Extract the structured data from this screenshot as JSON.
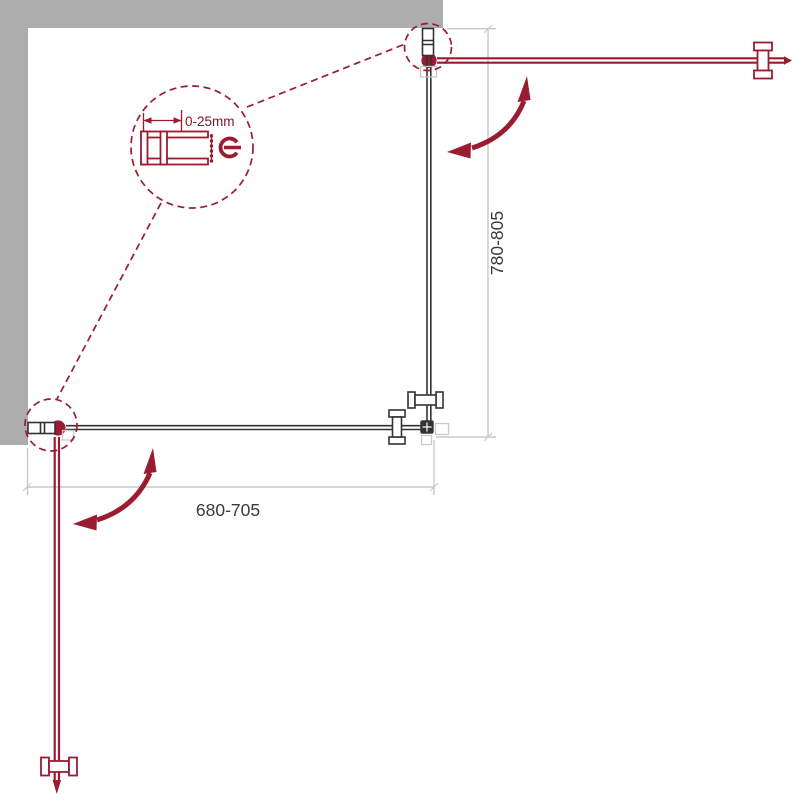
{
  "diagram": {
    "type": "shower-enclosure-installation-drawing",
    "dimensions": {
      "height_label": "780-805",
      "width_label": "680-705",
      "profile_adjustment_label": "0-25mm"
    }
  },
  "colors": {
    "red": "#9b1c31",
    "red-dark": "#7d1526",
    "wall-gray": "#adadad",
    "line-gray": "#c9c9c9",
    "dark": "#333333",
    "text-dark": "#3a3a3a",
    "bg": "#ffffff"
  }
}
